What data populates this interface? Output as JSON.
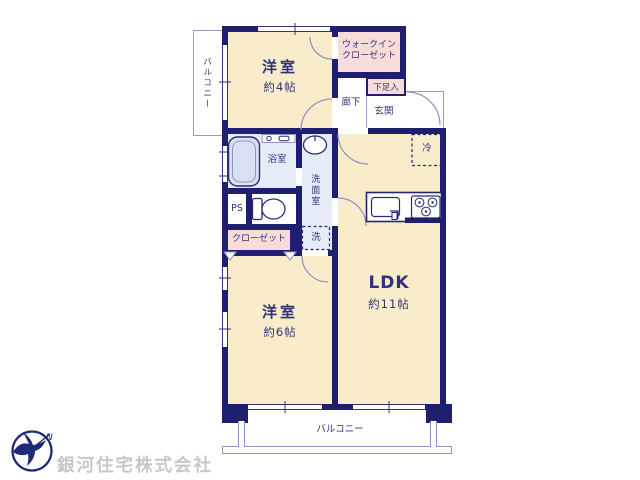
{
  "plan": {
    "rooms": {
      "bedroom4": {
        "label": "洋室",
        "size": "約4帖"
      },
      "wic_line1": "ウォークイン",
      "wic_line2": "クローゼット",
      "shoe_storage": "下足入",
      "hallway": "廊下",
      "entrance": "玄関",
      "refrigerator": "冷",
      "bathroom": "浴室",
      "washroom": "洗面室",
      "pipe_space": "PS",
      "closet": "クローゼット",
      "washer": "洗",
      "bedroom6": {
        "label": "洋室",
        "size": "約6帖"
      },
      "ldk": {
        "label": "LDK",
        "size": "約11帖"
      },
      "balcony_left": "バルコニー",
      "balcony_bottom": "バルコニー"
    },
    "footer": {
      "company": "銀河住宅株式会社",
      "logo_letter": "N"
    },
    "icons": [
      "bathtub-icon",
      "toilet-icon",
      "washbasin-icon",
      "kitchen-sink-icon",
      "stove-icon",
      "refrigerator-box",
      "washing-machine-box",
      "door-arc",
      "window-glyph",
      "compass-bird-logo"
    ],
    "colors": {
      "wall_navy": "#1f1f70",
      "room_cream": "#f9ecca",
      "closet_pink": "#f8dcda",
      "wet_area_blue": "#e6ecf7",
      "line_gray": "#8f93bd",
      "text_navy": "#32327c",
      "watermark_gray": "#c6c6cd"
    }
  }
}
